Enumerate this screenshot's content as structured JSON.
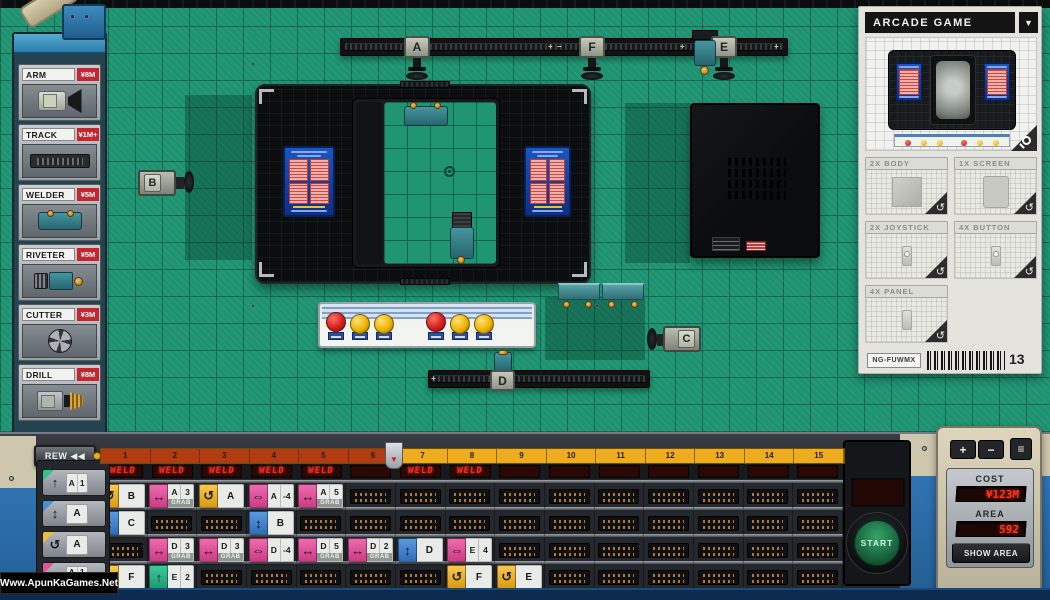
{
  "product_panel": {
    "title": "ARCADE GAME",
    "dropdown": "▼",
    "parts": [
      {
        "label": "2X BODY",
        "icon": "body-part"
      },
      {
        "label": "1X SCREEN",
        "icon": "screen-part"
      },
      {
        "label": "2X JOYSTICK",
        "icon": "joystick-part"
      },
      {
        "label": "4X BUTTON",
        "icon": "button-part"
      },
      {
        "label": "4X PANEL",
        "icon": "panel-part"
      }
    ],
    "serial": "NG-FUWMX",
    "count": "13"
  },
  "parts_palette": [
    {
      "name": "ARM",
      "price": "¥8M",
      "icon": "arm"
    },
    {
      "name": "TRACK",
      "price": "¥1M+",
      "icon": "track"
    },
    {
      "name": "WELDER",
      "price": "¥5M",
      "icon": "welder"
    },
    {
      "name": "RIVETER",
      "price": "¥5M",
      "icon": "riveter"
    },
    {
      "name": "CUTTER",
      "price": "¥3M",
      "icon": "cutter"
    },
    {
      "name": "DRILL",
      "price": "¥8M",
      "icon": "drill"
    }
  ],
  "floor": {
    "nodes": {
      "a": "A",
      "b": "B",
      "c": "C",
      "d": "D",
      "e": "E",
      "f": "F"
    },
    "track_marks": {
      "top_mid": "+ −",
      "top_e": "+",
      "top_end": "+",
      "bottom_start": "+"
    }
  },
  "transport": {
    "rew": "REW ◀◀",
    "skip": "SKIP ▶▶",
    "start": "START"
  },
  "timeline": {
    "units": 15,
    "elapsed_units": 6,
    "weld_label": "WELD",
    "weld_slots": [
      1,
      2,
      3,
      4,
      5,
      7,
      8
    ],
    "rows": [
      {
        "name": "instruction-row-1",
        "chips": [
          {
            "unit": 1,
            "kind": "rotate",
            "label": "B"
          },
          {
            "unit": 2,
            "kind": "move",
            "label": "A",
            "num": "3",
            "grab": true
          },
          {
            "unit": 3,
            "kind": "rotate",
            "label": "A"
          },
          {
            "unit": 4,
            "kind": "slide",
            "label": "A",
            "num": "-4"
          },
          {
            "unit": 5,
            "kind": "move",
            "label": "A",
            "num": "5",
            "grab": true
          }
        ]
      },
      {
        "name": "instruction-row-2",
        "chips": [
          {
            "unit": 1,
            "kind": "vmove",
            "label": "C"
          },
          {
            "unit": 4,
            "kind": "vmove",
            "label": "B"
          }
        ]
      },
      {
        "name": "instruction-row-3",
        "chips": [
          {
            "unit": 2,
            "kind": "move",
            "label": "D",
            "num": "3",
            "grab": true
          },
          {
            "unit": 3,
            "kind": "move",
            "label": "D",
            "num": "3",
            "grab": true
          },
          {
            "unit": 4,
            "kind": "slide",
            "label": "D",
            "num": "-4"
          },
          {
            "unit": 5,
            "kind": "move",
            "label": "D",
            "num": "5",
            "grab": true
          },
          {
            "unit": 6,
            "kind": "move",
            "label": "D",
            "num": "2",
            "grab": true
          },
          {
            "unit": 7,
            "kind": "vmove",
            "label": "D"
          },
          {
            "unit": 8,
            "kind": "slide",
            "label": "E",
            "num": "4"
          }
        ]
      },
      {
        "name": "instruction-row-4",
        "chips": [
          {
            "unit": 1,
            "kind": "rotate",
            "label": "F"
          },
          {
            "unit": 2,
            "kind": "umove",
            "label": "E",
            "num": "2"
          },
          {
            "unit": 8,
            "kind": "rotate",
            "label": "F"
          },
          {
            "unit": 9,
            "kind": "rotate",
            "label": "E"
          }
        ]
      }
    ]
  },
  "legend": [
    {
      "kind": "umove",
      "corner": "green",
      "label": "A",
      "num": "1"
    },
    {
      "kind": "vmove",
      "corner": "blue",
      "label": "A"
    },
    {
      "kind": "rotate",
      "corner": "yellow",
      "label": "A"
    },
    {
      "kind": "move",
      "corner": "magenta",
      "label": "A",
      "num": "1",
      "grab": true
    }
  ],
  "grab_label": "GRAB",
  "meters": {
    "plus": "+",
    "minus": "−",
    "menu": "≡",
    "cost_label": "COST",
    "cost_value": "¥123M",
    "area_label": "AREA",
    "area_value": "592",
    "show_area": "SHOW AREA"
  },
  "watermark": "Www.ApunKaGames.Net"
}
